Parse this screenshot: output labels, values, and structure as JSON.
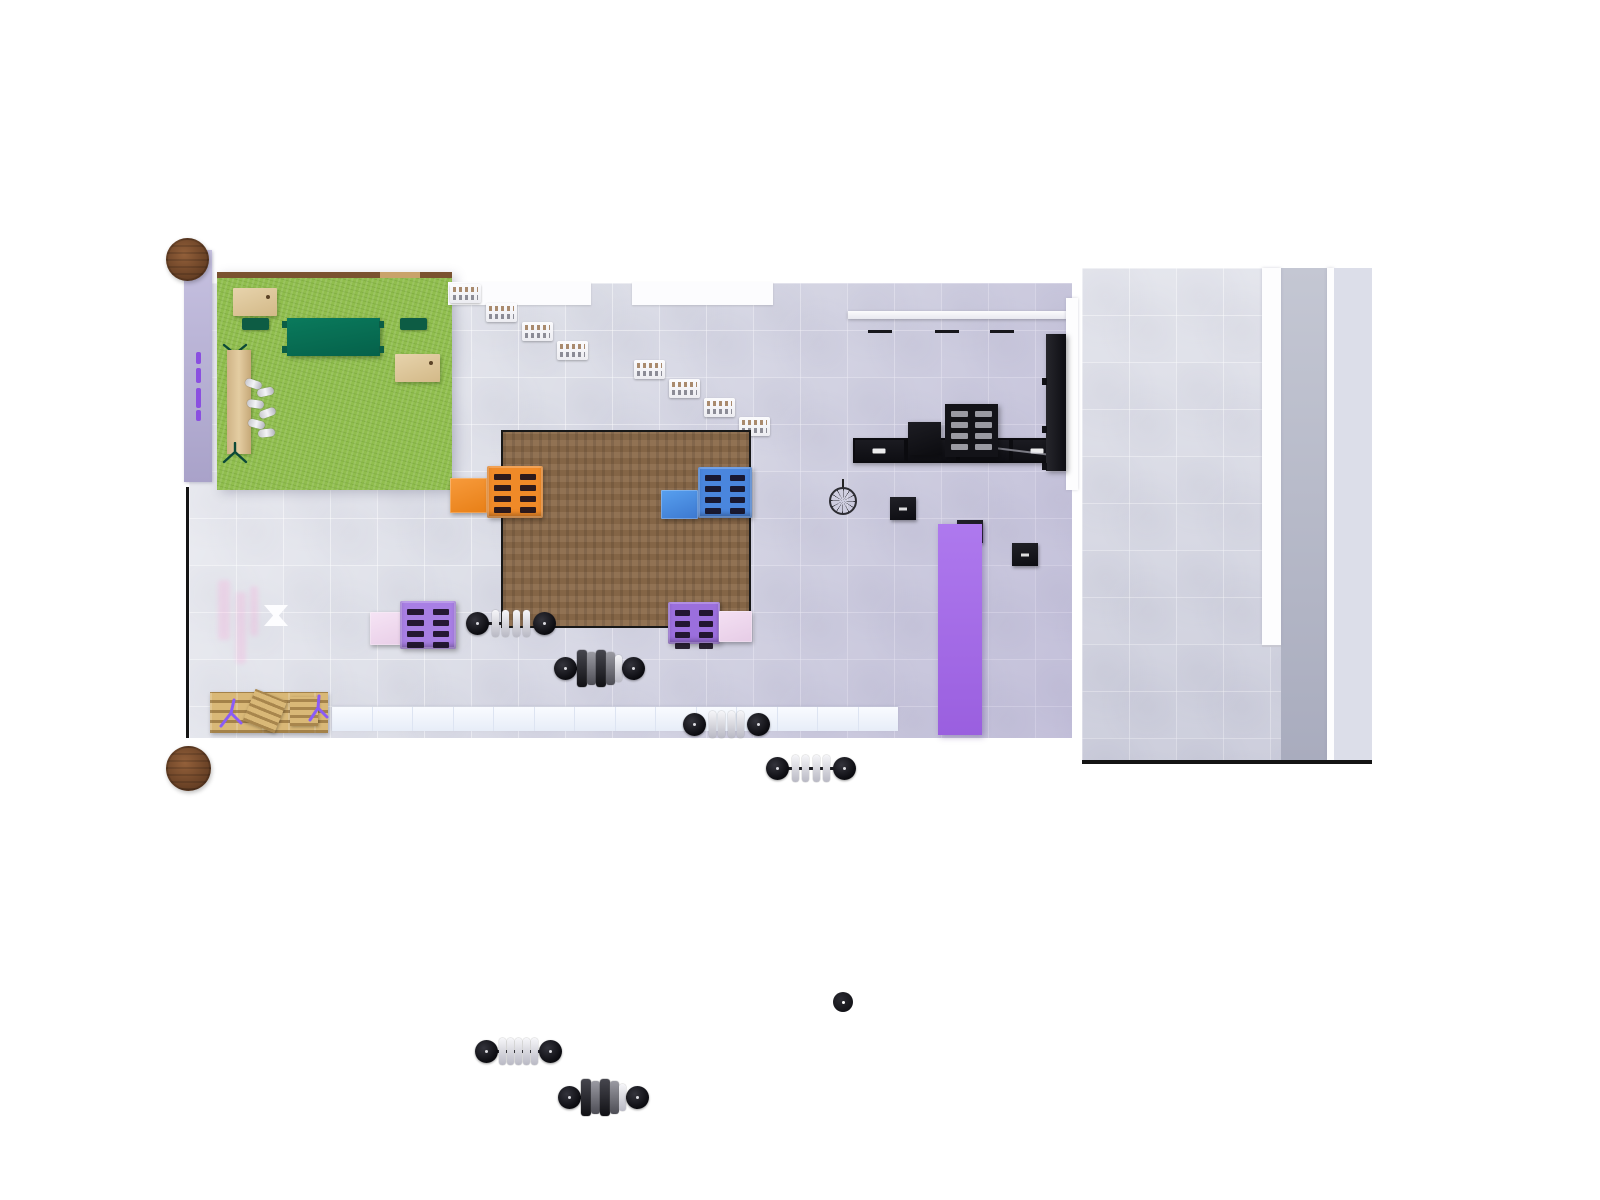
{
  "scene": {
    "title": "Gym facility floor plan — top-down 3D render",
    "visible_text": "none (equipment console labels too small to read)"
  },
  "palette": {
    "page-bg": "#ffffff",
    "floor-base": "#d9dbe5",
    "floor-tint": "#b3abce",
    "turf": "#90be4e",
    "wood-edge": "#7a5230",
    "table-wood": "#6a4226",
    "platform": "#8b6a4a",
    "platform-border": "#181818",
    "green-dark": "#076b50",
    "chair-green": "#0d5c44",
    "black-equip": "#131318",
    "white-equip": "#f7f8fa",
    "chrome": "#e9e9ee",
    "orange": "#f08a28",
    "blue": "#4a86dd",
    "purple-rack": "#9b6fdd",
    "purple-rack-light": "#a87fe4",
    "pink-box": "#f0dcf0",
    "purple-column": "#a56fe8",
    "lavender": "#b6b0d8",
    "purple-dash": "#8a4fe0",
    "cubby": "#eef3fb",
    "pallet-wood": "#d9b877",
    "tripod": "#8b5cf6",
    "wall": "#141414"
  },
  "zones": {
    "turf_area": {
      "label": "artificial turf corner",
      "items": [
        "wood desk + green chair (x2)",
        "dark green bench mat",
        "wood bench with trestles",
        "chrome dumbbell set"
      ]
    },
    "main_floor": {
      "label": "main training floor",
      "items": [
        "lifting platform (wood)",
        "orange pallet rack + orange box",
        "blue pallet rack + blue box",
        "purple pallet rack + pink box (x2)",
        "loaded barbells (x6)",
        "pedestal fan",
        "purple column mat",
        "white X floor marker",
        "dumbbell shelf (black)",
        "black plyo box",
        "cubby shelf row",
        "wood pallets with purple tripods",
        "round wood tables (x2)",
        "lavender wall strip with purple dashes"
      ]
    },
    "cardio_zone": {
      "label": "top cardio row",
      "items": [
        "white rowers (x8)",
        "black treadmill row (x4)",
        "consoles (x3)",
        "tall black wall rack"
      ]
    },
    "right_hall": {
      "label": "right hall",
      "items": [
        "white divider column",
        "white wall strip",
        "dark walkway strip"
      ]
    }
  },
  "equipment_counts": {
    "barbells": 6,
    "pallet_racks": 4,
    "side_boxes": 4,
    "treadmills": 4,
    "white_cardio_units": 8,
    "round_tables": 2,
    "fans": 1
  }
}
